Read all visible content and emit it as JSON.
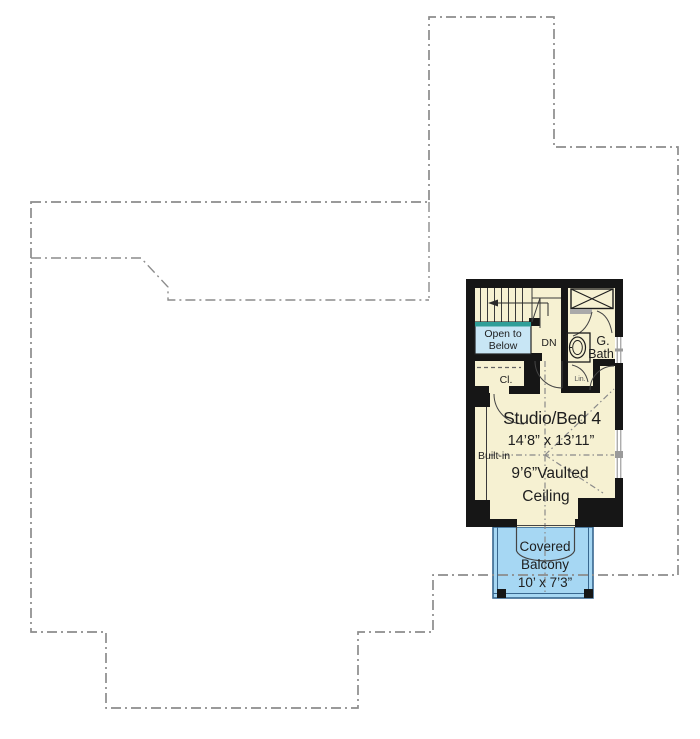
{
  "plan": {
    "title": "Upper floor plan",
    "labels": {
      "open_to_below_line1": "Open to",
      "open_to_below_line2": "Below",
      "dn": "DN",
      "closet": "Cl.",
      "bath_line1": "G.",
      "bath_line2": "Bath",
      "linen": "Lin.",
      "room_name": "Studio/Bed 4",
      "room_dims": "14’8” x 13’11”",
      "ceiling_line1": "9’6”Vaulted",
      "ceiling_line2": "Ceiling",
      "built_in": "Built-in",
      "balcony_line1": "Covered",
      "balcony_line2": "Balcony",
      "balcony_dims": "10’ x 7’3”"
    },
    "colors": {
      "room_fill": "#f6f1d2",
      "open_below_fill": "#c8e6f5",
      "open_below_bar": "#2f9e98",
      "balcony_fill": "#a6d7f3",
      "balcony_edge": "#38678f",
      "wall": "#161616",
      "footprint_dash": "#8c8c8c",
      "ceiling_dash": "#8a8a8a"
    }
  }
}
